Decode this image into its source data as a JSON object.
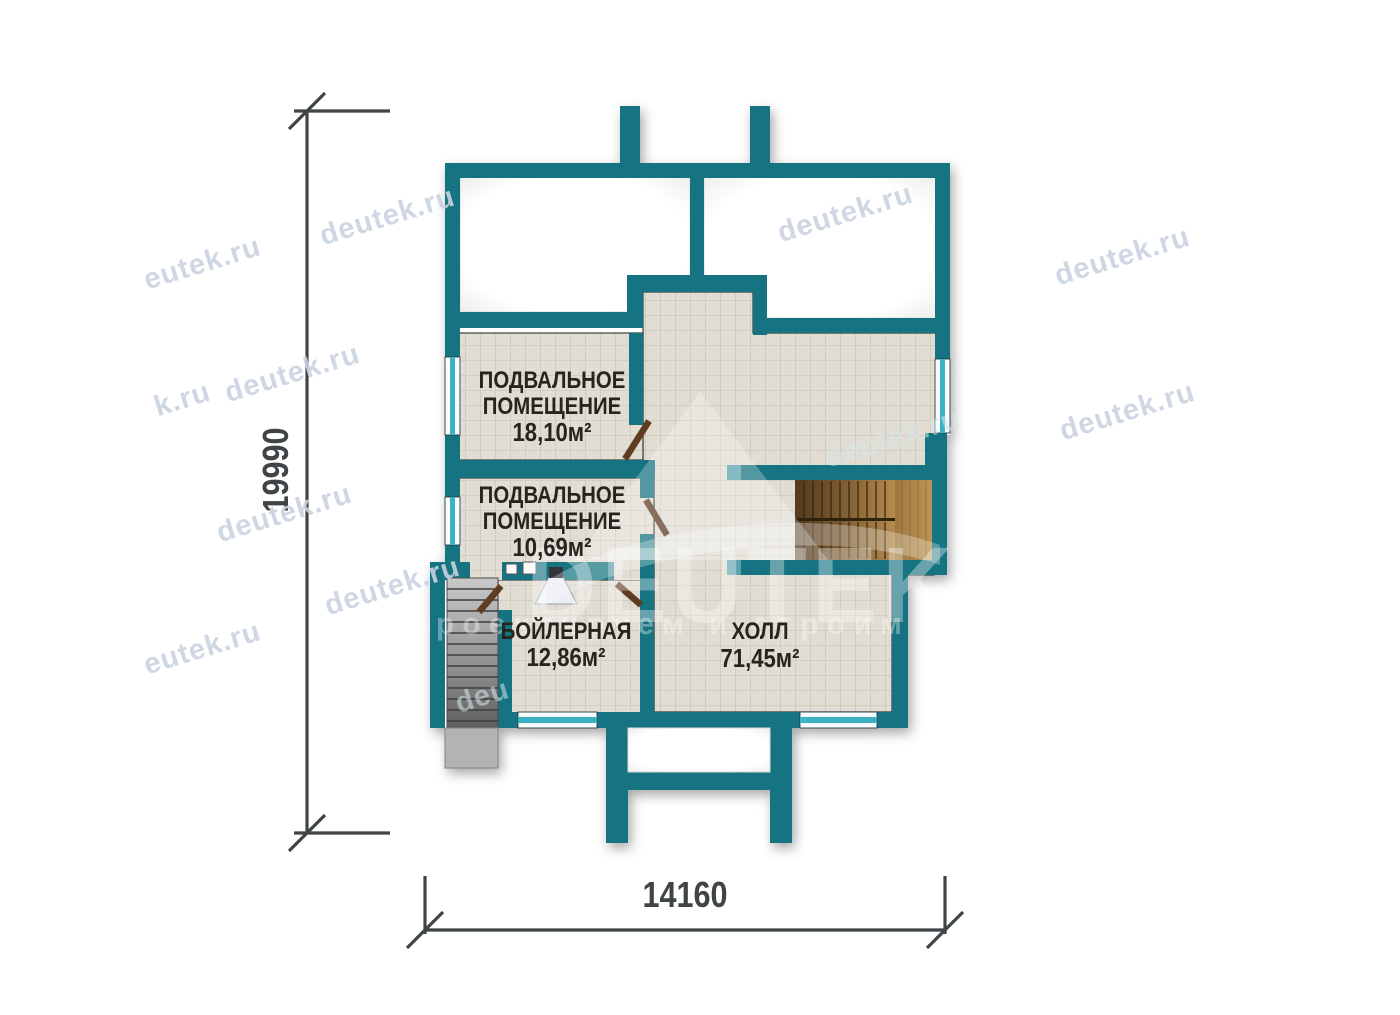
{
  "rooms": [
    {
      "lines": [
        "ПОДВАЛЬНОЕ",
        "ПОМЕЩЕНИЕ"
      ],
      "area": "18,10м²"
    },
    {
      "lines": [
        "ПОДВАЛЬНОЕ",
        "ПОМЕЩЕНИЕ"
      ],
      "area": "10,69м²"
    },
    {
      "lines": [
        "БОЙЛЕРНАЯ"
      ],
      "area": "12,86м²"
    },
    {
      "lines": [
        "ХОЛЛ"
      ],
      "area": "71,45м²"
    }
  ],
  "dimensions": {
    "vertical": "19990",
    "horizontal": "14160"
  },
  "brand": {
    "name": "DEUTEK",
    "tagline": "проектируем и строим"
  },
  "watermarks": [
    {
      "text": "eutek.ru"
    },
    {
      "text": "deutek.ru"
    },
    {
      "text": "deutek.ru"
    },
    {
      "text": "deutek.ru"
    },
    {
      "text": "deutek.ru"
    },
    {
      "text": "k.ru"
    },
    {
      "text": "deutek.ru"
    },
    {
      "text": "deutek.ru"
    },
    {
      "text": "deutek.ru"
    },
    {
      "text": "eutek.ru"
    },
    {
      "text": "deutek.ru"
    },
    {
      "text": "deu"
    }
  ],
  "colors": {
    "wall": "#187381",
    "window": "#3ab3c4",
    "tile": "#e1ddd3",
    "wood": "#a87f45",
    "stair": "#9a9a9a",
    "dimension": "#3f4447"
  }
}
